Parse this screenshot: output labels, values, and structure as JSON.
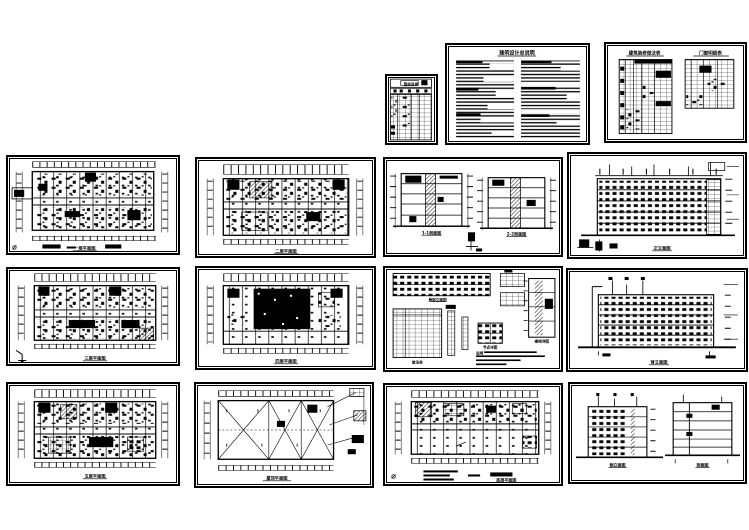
{
  "colors": {
    "paper": "#ffffff",
    "ink": "#000000"
  },
  "icons": {
    "north_symbol": "⌀"
  },
  "sheets": {
    "index": {
      "title": "图纸目录"
    },
    "notes": {
      "title": "建筑设计总说明"
    },
    "schedules": {
      "left_title": "建筑装修做法表",
      "right_title": "门窗明细表"
    },
    "plan1": {
      "caption": "一层平面图"
    },
    "plan2": {
      "caption": "二层平面图"
    },
    "sections": {
      "caption_left": "1-1剖面图",
      "caption_right": "2-2剖面图"
    },
    "elev_front": {
      "caption": "正立面图"
    },
    "plan3": {
      "caption": "三层平面图"
    },
    "plan4": {
      "caption": "四层平面图"
    },
    "details": {
      "strip_caption": "局部立面图",
      "table_caption": "做法表",
      "stair_caption": "楼梯详图",
      "node_caption": "节点详图",
      "notes_label": "说明"
    },
    "elev_back": {
      "caption": "背立面图"
    },
    "plan5": {
      "caption": "五层平面图"
    },
    "roof": {
      "caption": "屋顶平面图"
    },
    "plan_ground": {
      "caption": "底层平面图"
    },
    "side": {
      "caption_left": "侧立面图",
      "caption_right": "剖面图"
    }
  }
}
